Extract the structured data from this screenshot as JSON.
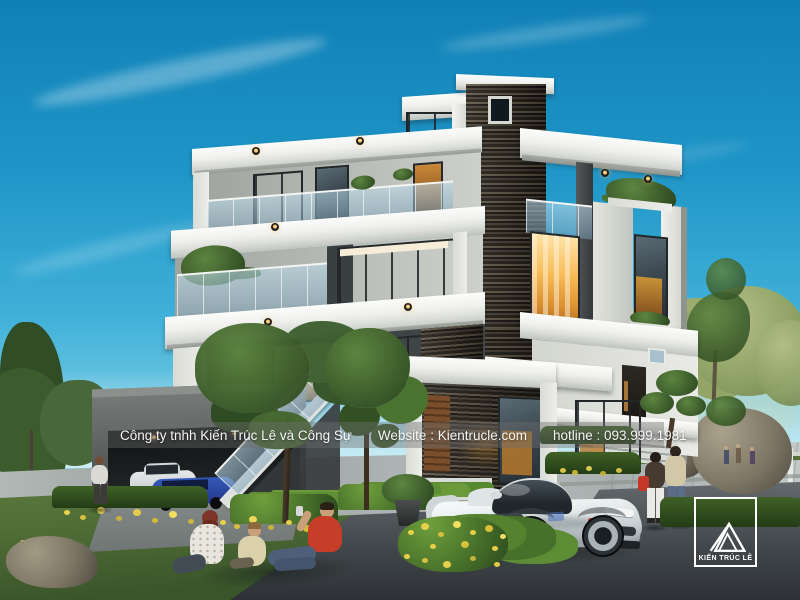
{
  "watermark": {
    "company": "Công ty tnhh Kiến Trúc Lê và Công Sự",
    "website": "Website : Kientrucle.com",
    "hotline": "hotline : 093.999.1981"
  },
  "logo": {
    "title": "KIẾN TRÚC LÊ"
  },
  "palette": {
    "sky_top": "#1583ba",
    "sky_horizon": "#c9ecf5",
    "wall_white": "#f2f3ef",
    "stone_dark": "#332e28",
    "warm_light": "#f7ba55",
    "glass_blue": "#a9cde0",
    "grass_green": "#4e6c35",
    "flower_yellow": "#e9d14e",
    "road_grey": "#4a5053",
    "accent_red": "#c63d28"
  }
}
